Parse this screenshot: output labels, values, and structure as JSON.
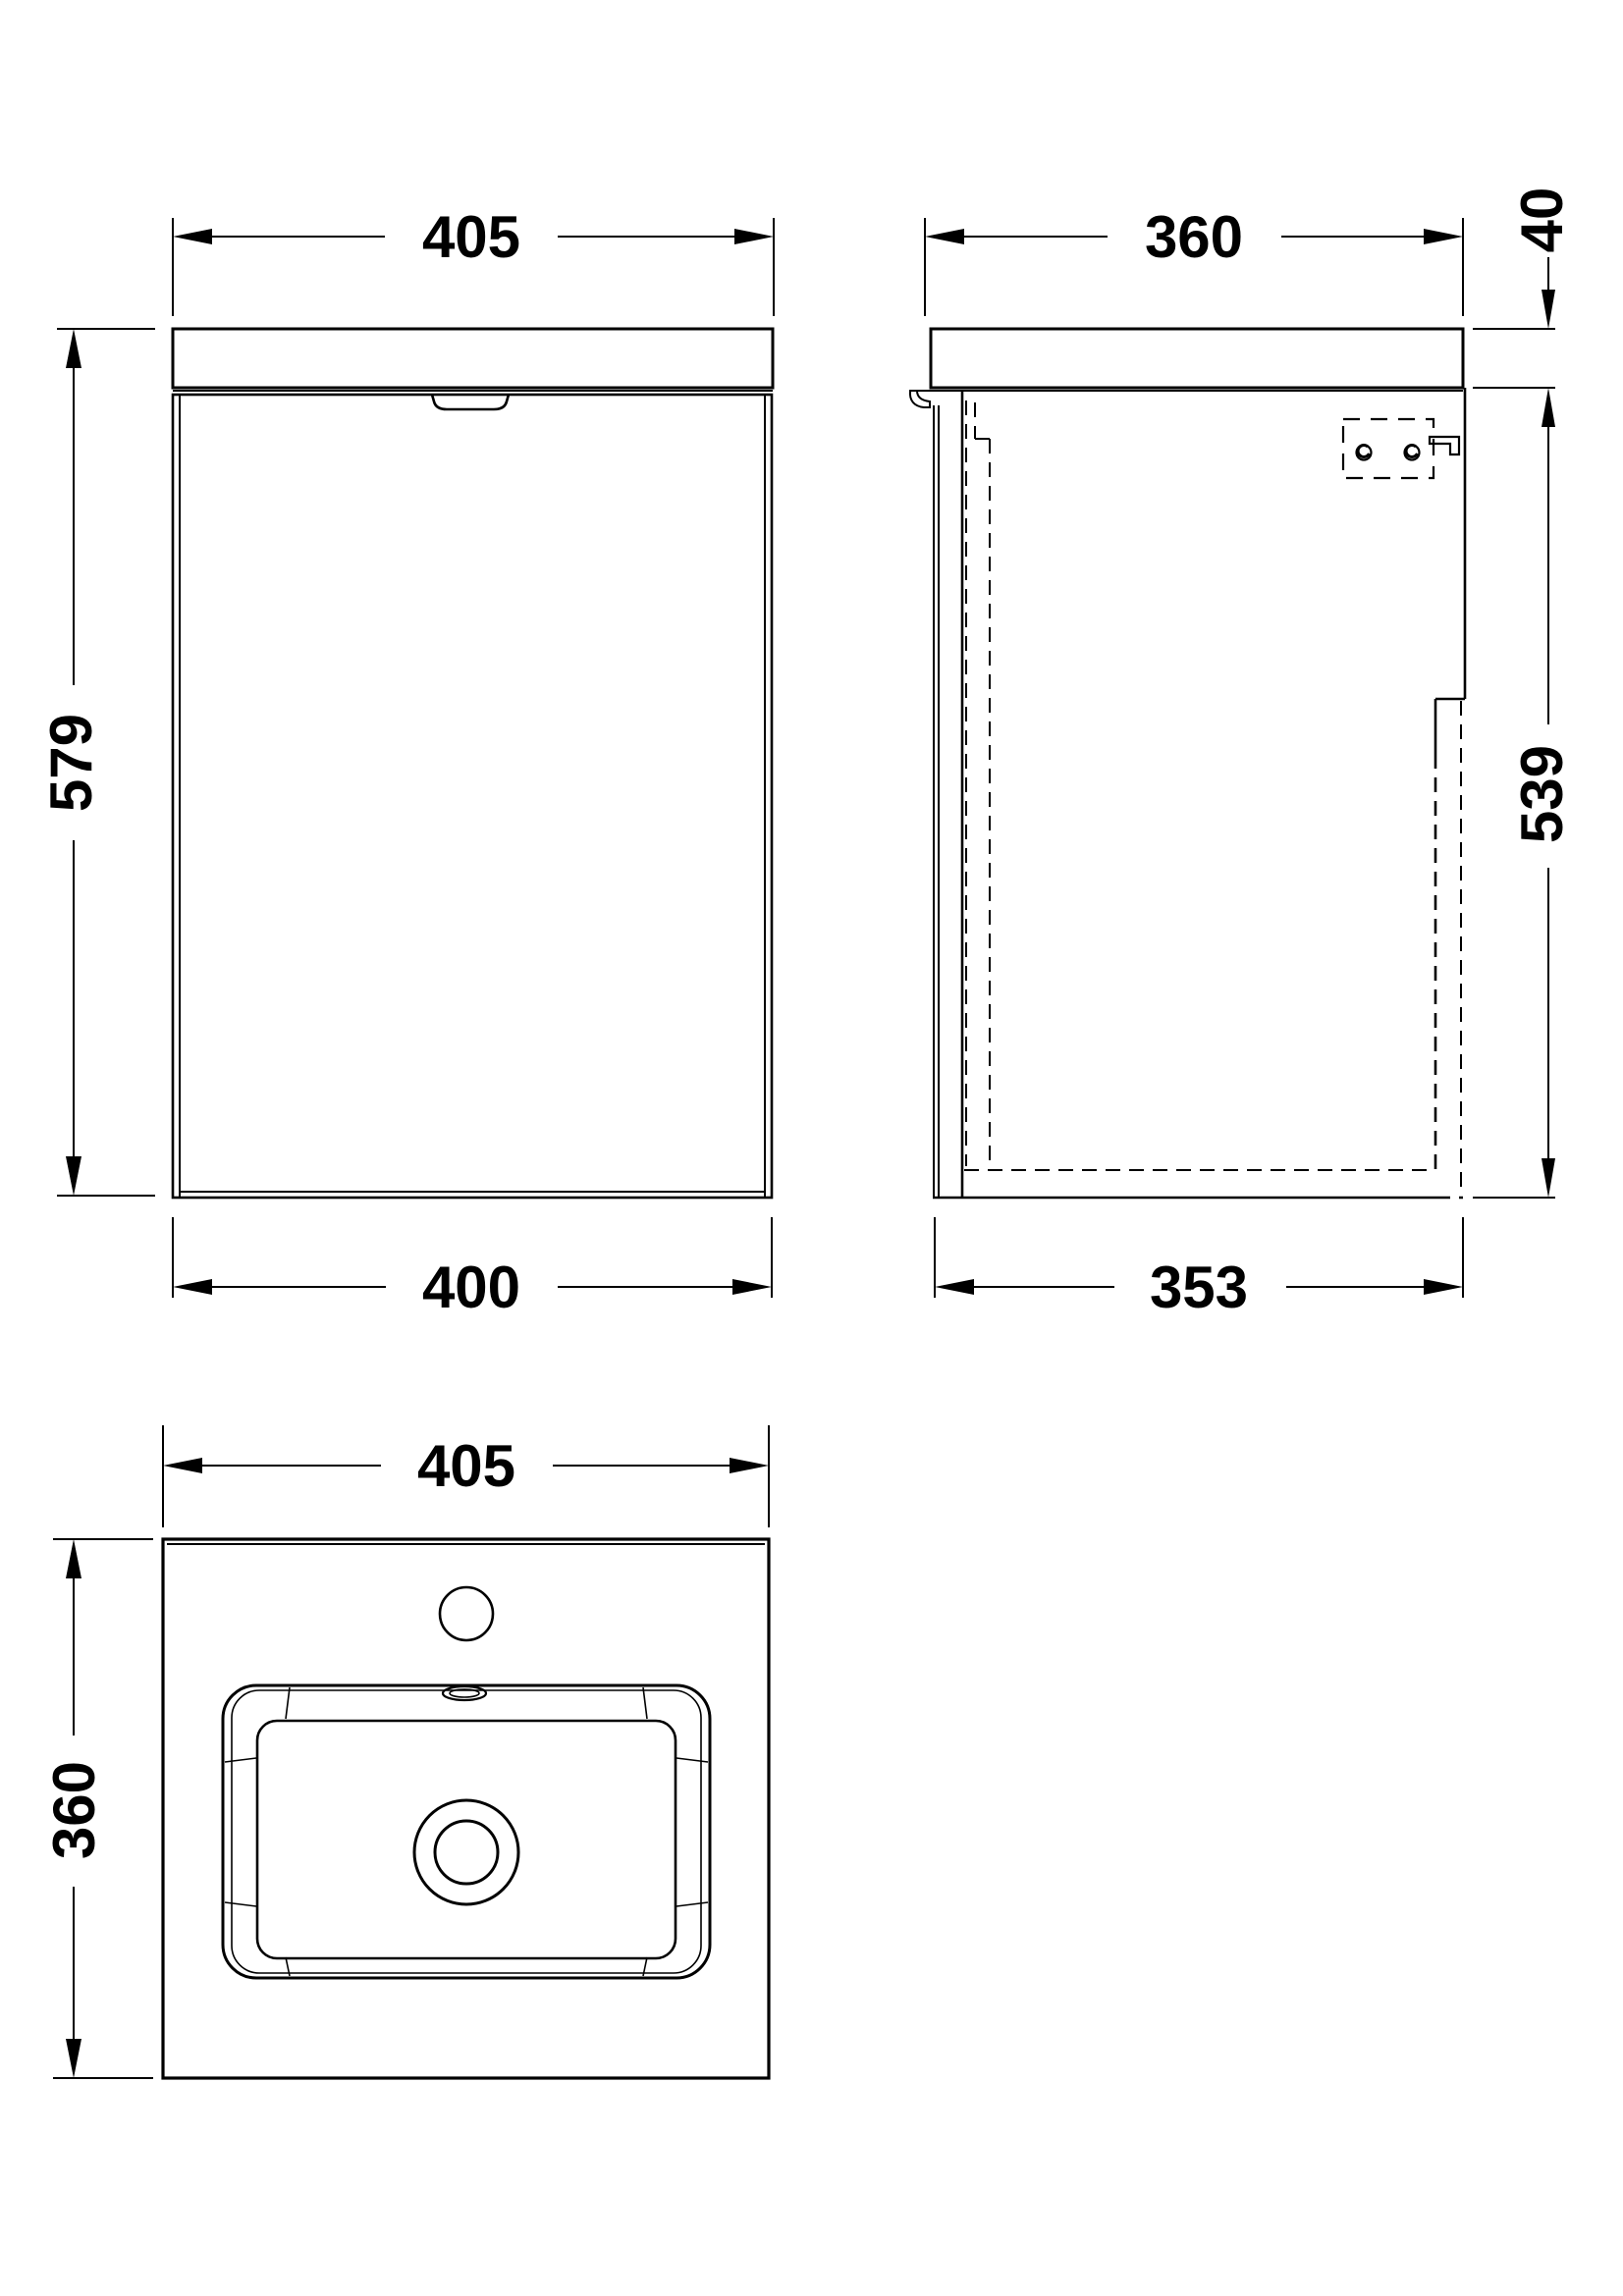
{
  "drawing": {
    "type": "technical-dimension-drawing",
    "unit": "mm",
    "front": {
      "width_top": "405",
      "height": "579",
      "width_bottom": "400"
    },
    "side": {
      "depth_top": "360",
      "worktop_thickness": "40",
      "cabinet_height": "539",
      "depth_bottom": "353"
    },
    "plan": {
      "width": "405",
      "depth": "360"
    }
  },
  "colors": {
    "line": "#000000",
    "background": "#ffffff"
  }
}
